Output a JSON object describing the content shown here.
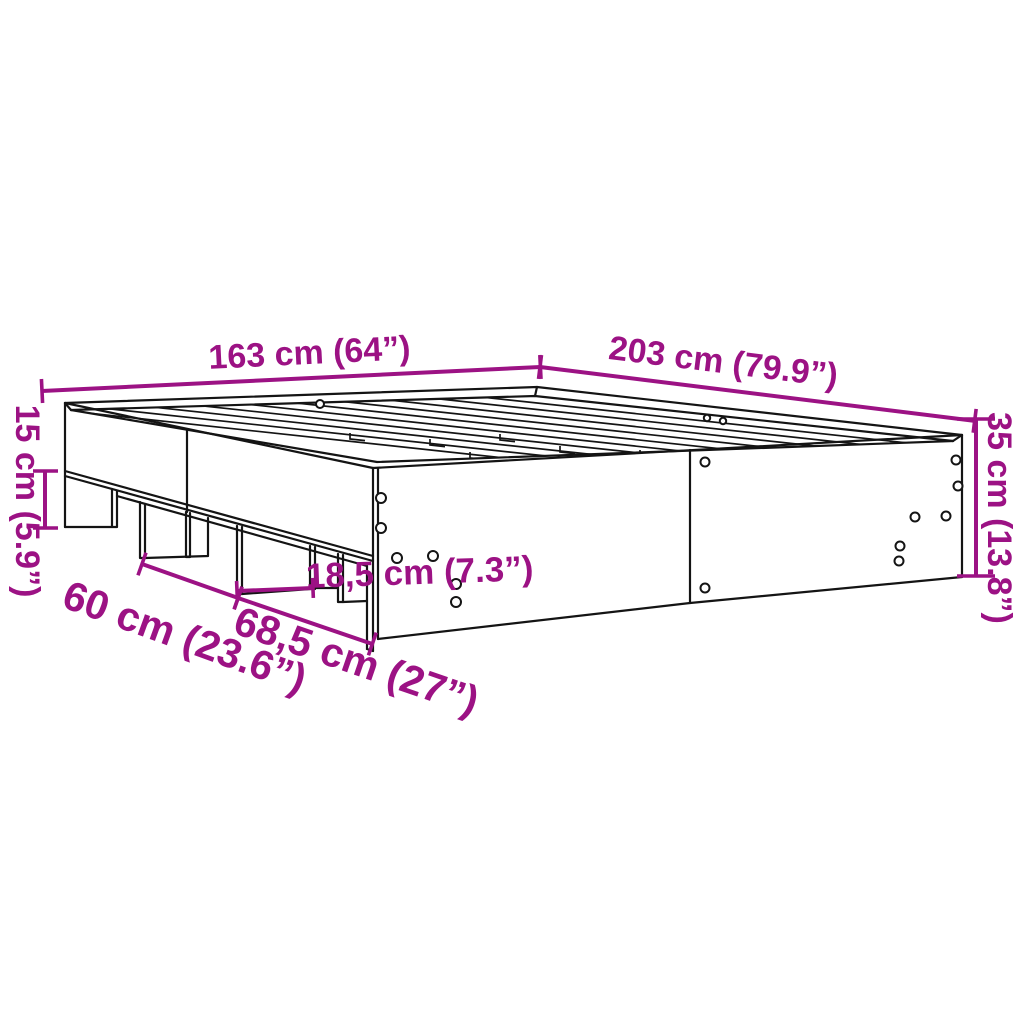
{
  "diagram": {
    "subject": "bed-frame-dimension-diagram",
    "colors": {
      "dimension_accent": "#9C1284",
      "line": "#141414",
      "background": "#FFFFFF"
    },
    "dimensions": {
      "width_top": {
        "label": "163 cm (64”)"
      },
      "length_top": {
        "label": "203 cm (79.9”)"
      },
      "plinth_height_left": {
        "label": "15 cm (5.9”)"
      },
      "frame_height_right": {
        "label": "35 cm (13.8”)"
      },
      "leg_width_middle": {
        "label": "18,5 cm (7.3”)"
      },
      "leg_spacing_left": {
        "label": "60 cm (23.6”)"
      },
      "leg_spacing_front": {
        "label": "68,5 cm (27”)"
      }
    }
  }
}
